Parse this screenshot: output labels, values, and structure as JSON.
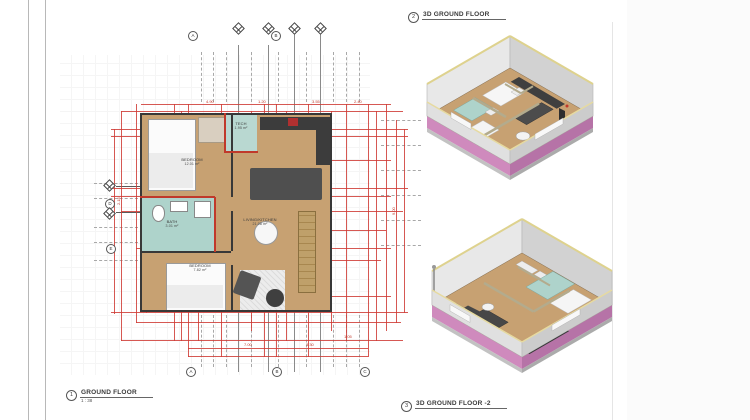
{
  "callouts": {
    "plan": {
      "num": "1",
      "title": "GROUND FLOOR",
      "scale": "1 : 38"
    },
    "iso1": {
      "num": "2",
      "title": "3D GROUND FLOOR"
    },
    "iso2": {
      "num": "3",
      "title": "3D GROUND FLOOR -2"
    }
  },
  "plan": {
    "rooms": {
      "bedroom1": {
        "label": "BEDROOM",
        "area": "12.01 m²"
      },
      "tech": {
        "label": "TECH",
        "area": "1.95 m²"
      },
      "bath": {
        "label": "BATH",
        "area": "3.01 m²"
      },
      "bedroom2": {
        "label": "BEDROOM",
        "area": "7.82 m²"
      },
      "living": {
        "label": "LIVING/KITCHEN",
        "area": "21.08 m²"
      }
    },
    "grid": {
      "top": [
        "A",
        "B"
      ],
      "bottom": [
        "A",
        "B",
        "C"
      ],
      "left": [
        "D",
        "E"
      ]
    },
    "dims": [
      "4.90",
      "1.20",
      "3.55",
      "2.40",
      "7.00",
      "3.30",
      "1.05",
      "2.15",
      "4.75",
      "9.00"
    ]
  },
  "colors": {
    "dimension_red": "#cf3b35",
    "wall_dark": "#383838",
    "floor_tan": "#c7a172",
    "bath_teal": "#aed3cb",
    "plinth_pink": "#c77fb8",
    "furniture_dark": "#4c4c4c"
  }
}
